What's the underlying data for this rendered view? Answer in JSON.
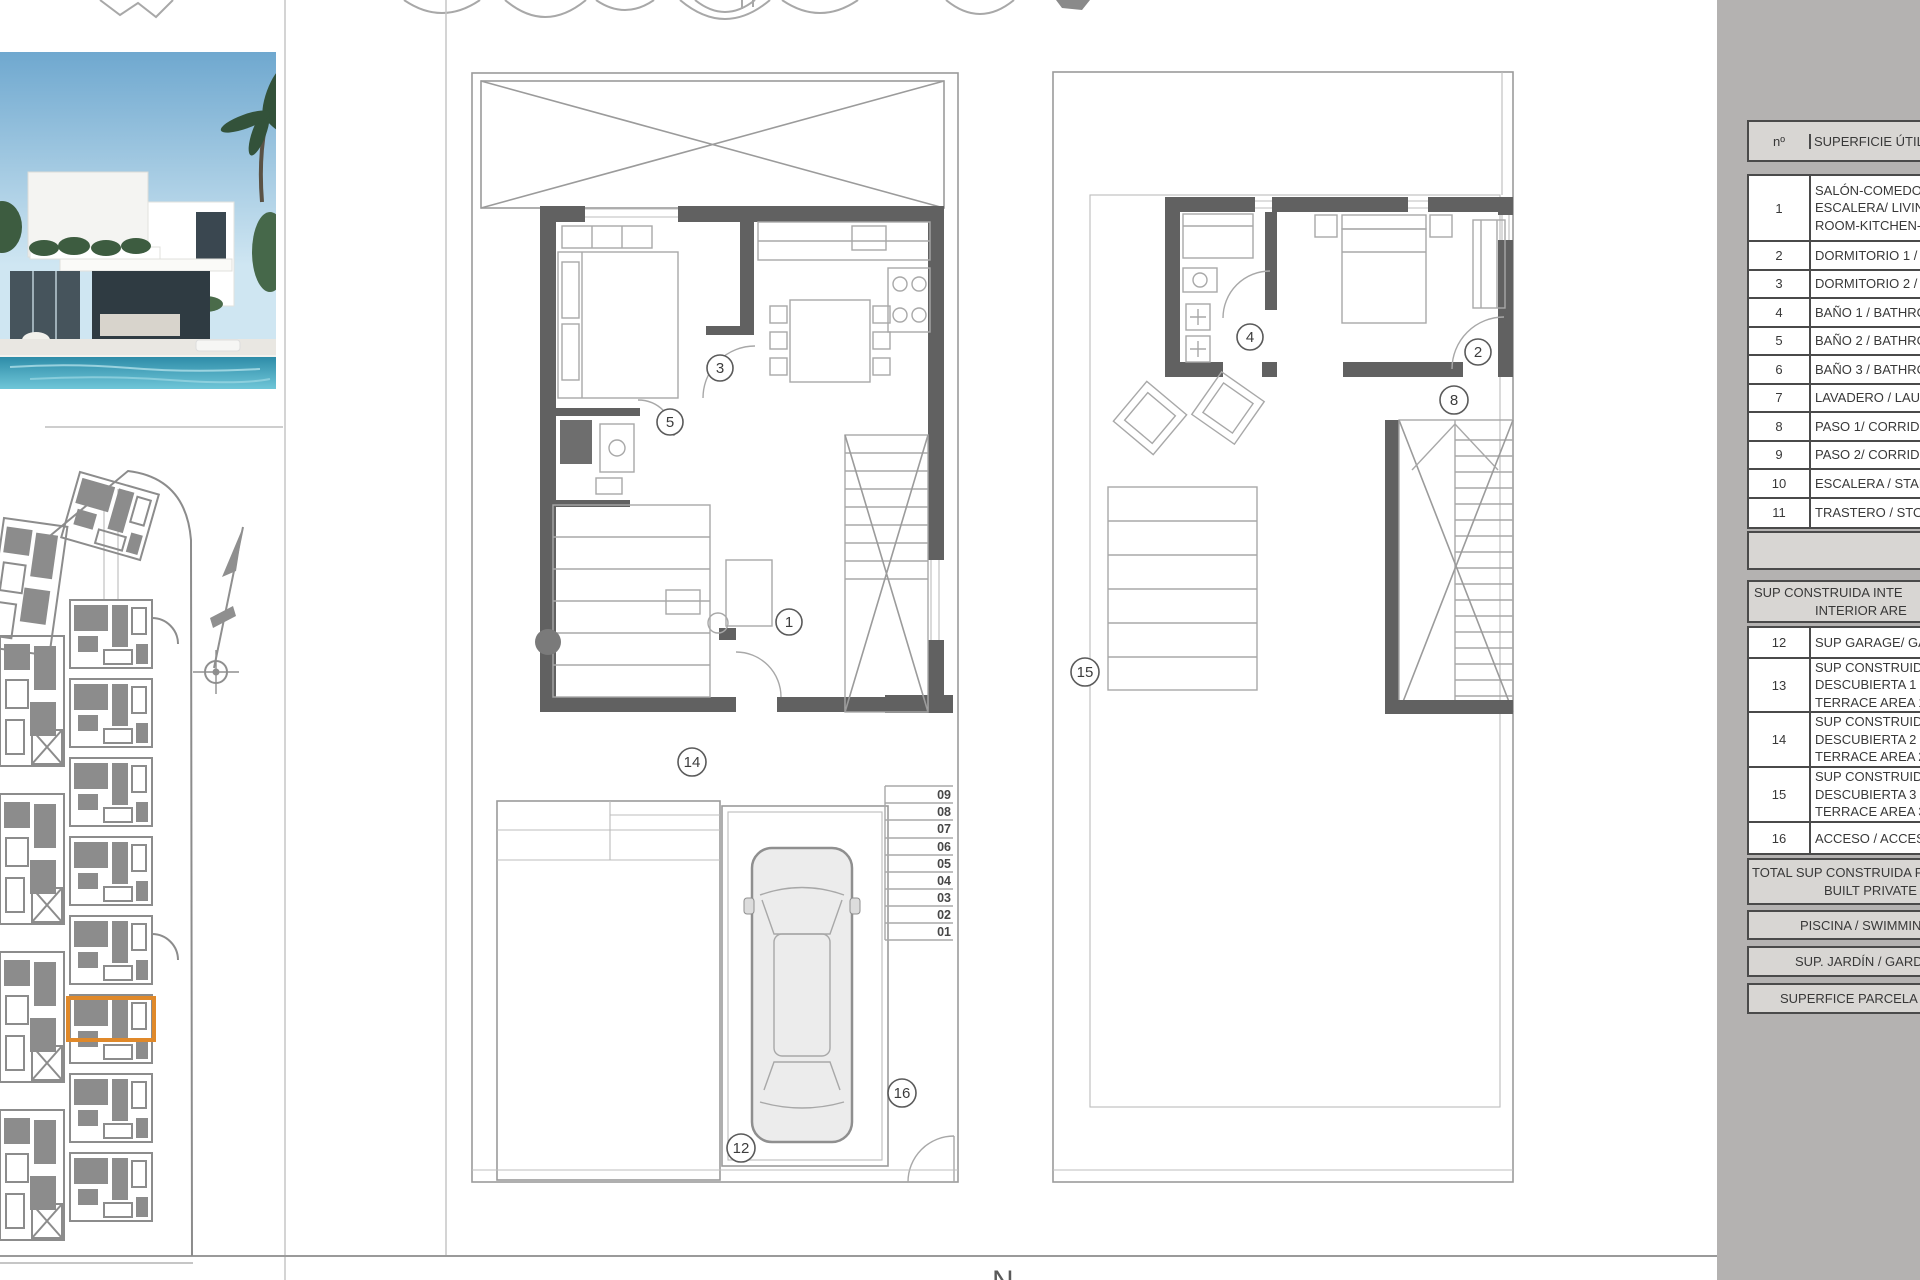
{
  "sheet": {
    "bottom_clipped_text": "N"
  },
  "site_plan": {
    "highlight_color": "#e0892a"
  },
  "plan_ground": {
    "c1": "1",
    "c3": "3",
    "c5": "5",
    "c12": "12",
    "c14": "14",
    "c16": "16",
    "steps": [
      "09",
      "08",
      "07",
      "06",
      "05",
      "04",
      "03",
      "02",
      "01"
    ]
  },
  "plan_first": {
    "c2": "2",
    "c4": "4",
    "c8": "8",
    "c15": "15"
  },
  "area_table": {
    "header_num": "nº",
    "header_title": "SUPERFICIE ÚTILE",
    "rows_utiles": [
      {
        "n": "1",
        "lines": [
          "SALÓN-COMEDO",
          "ESCALERA/ LIVIN",
          "ROOM-KITCHEN-"
        ]
      },
      {
        "n": "2",
        "lines": [
          "DORMITORIO 1 /"
        ]
      },
      {
        "n": "3",
        "lines": [
          "DORMITORIO 2 /"
        ]
      },
      {
        "n": "4",
        "lines": [
          "BAÑO 1 / BATHRO"
        ]
      },
      {
        "n": "5",
        "lines": [
          "BAÑO 2 / BATHRO"
        ]
      },
      {
        "n": "6",
        "lines": [
          "BAÑO 3 / BATHRO"
        ]
      },
      {
        "n": "7",
        "lines": [
          "LAVADERO / LAU"
        ]
      },
      {
        "n": "8",
        "lines": [
          "PASO 1/ CORRIDO"
        ]
      },
      {
        "n": "9",
        "lines": [
          "PASO 2/ CORRIDO"
        ]
      },
      {
        "n": "10",
        "lines": [
          "ESCALERA / STAIR"
        ]
      },
      {
        "n": "11",
        "lines": [
          "TRASTERO / STOR"
        ]
      }
    ],
    "section_interior": [
      "SUP CONSTRUIDA INTE",
      "INTERIOR ARE"
    ],
    "rows_built": [
      {
        "n": "12",
        "lines": [
          "SUP GARAGE/ GA"
        ]
      },
      {
        "n": "13",
        "lines": [
          "SUP CONSTRUIDA",
          "DESCUBIERTA 1 /",
          "TERRACE AREA 1"
        ]
      },
      {
        "n": "14",
        "lines": [
          "SUP CONSTRUIDA",
          "DESCUBIERTA 2 /",
          "TERRACE AREA 2"
        ]
      },
      {
        "n": "15",
        "lines": [
          "SUP CONSTRUIDA",
          "DESCUBIERTA 3 /",
          "TERRACE AREA 3"
        ]
      },
      {
        "n": "16",
        "lines": [
          "ACCESO / ACCESS"
        ]
      }
    ],
    "total_lines": [
      "TOTAL SUP CONSTRUIDA PR",
      "BUILT PRIVATE A"
    ],
    "piscina": "PISCINA / SWIMMIN",
    "jardin": "SUP. JARDÍN / GARD",
    "parcela": "SUPERFICE PARCELA /"
  }
}
